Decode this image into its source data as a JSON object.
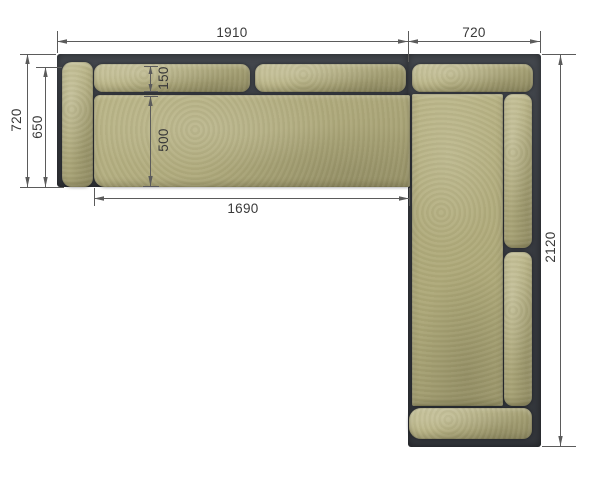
{
  "drawing": {
    "description": "Corner sofa top view dimension drawing",
    "dimensions": {
      "total_width": "1910",
      "right_section_width": "720",
      "left_depth": "720",
      "left_inner_depth": "650",
      "backrest_depth": "150",
      "seat_depth": "500",
      "seat_length": "1690",
      "total_length": "2120"
    },
    "colors": {
      "frame": "#3b3e44",
      "cushion": "#b2ad7f",
      "dimension_line": "#5b5b5b",
      "label_text": "#3a3a3a",
      "background": "#ffffff"
    }
  }
}
